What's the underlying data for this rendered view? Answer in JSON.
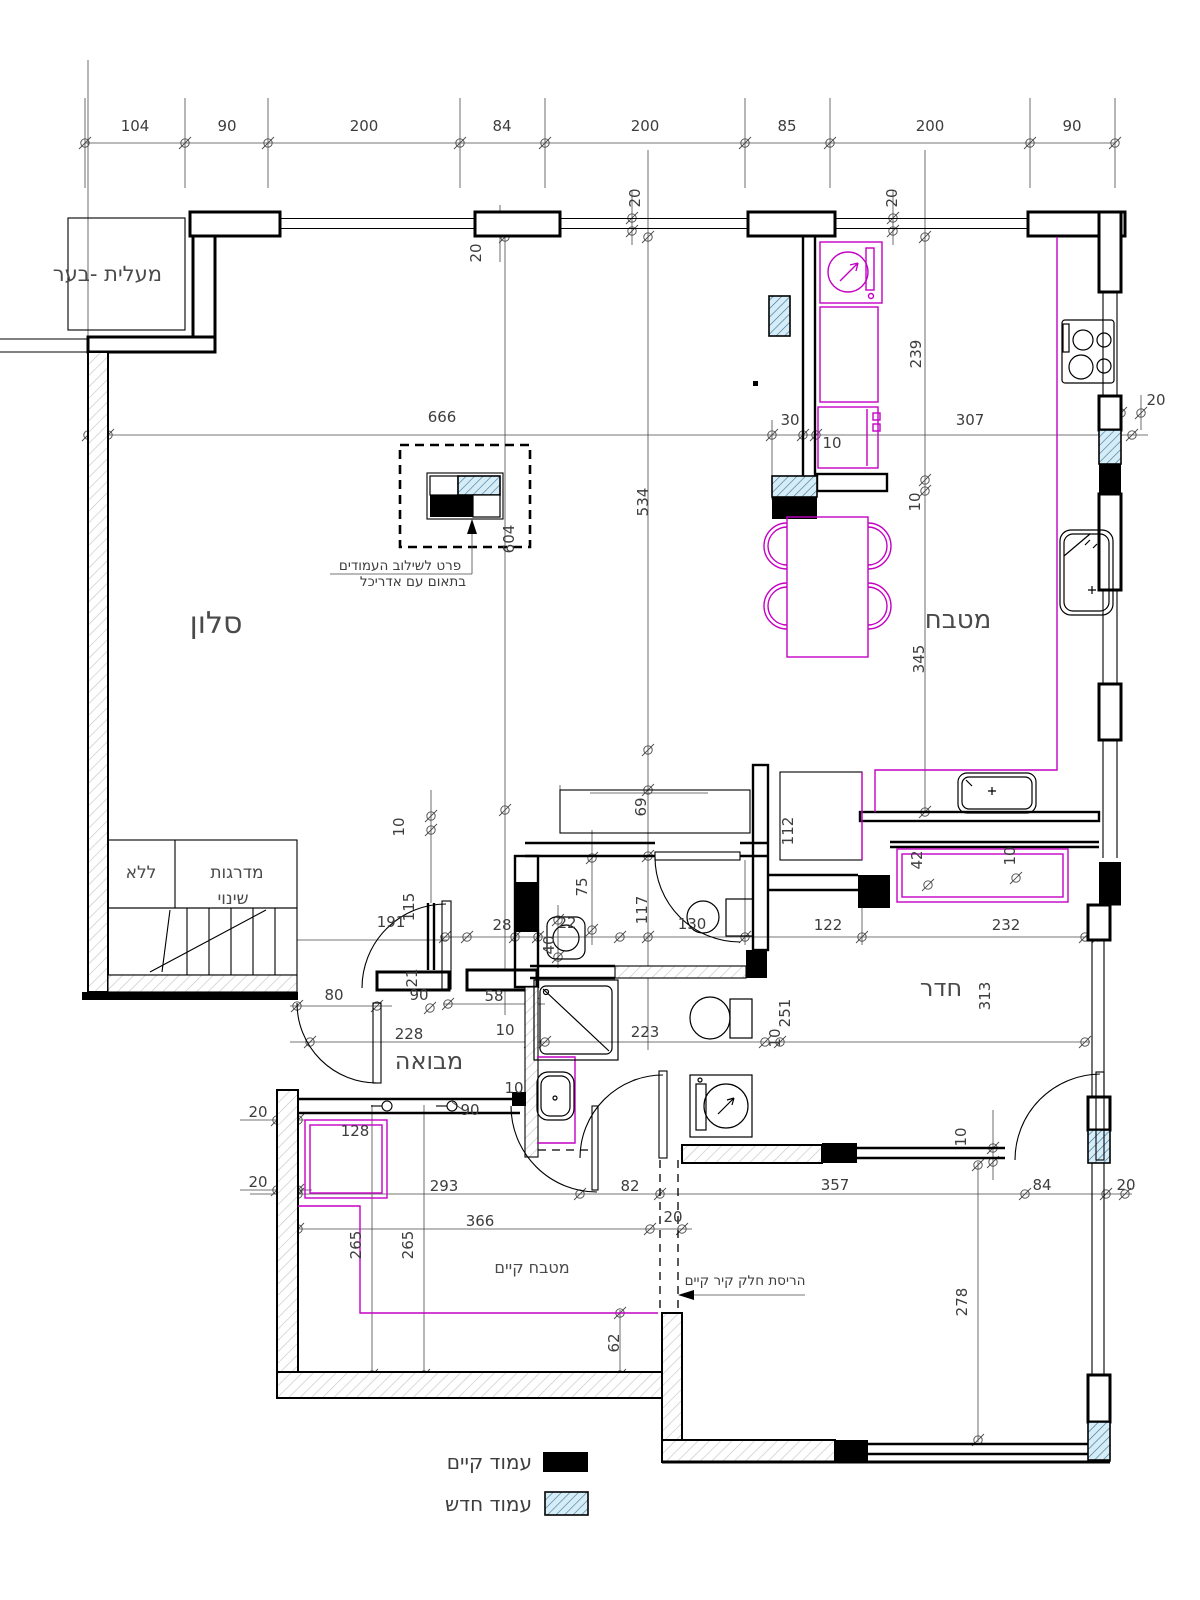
{
  "drawing": {
    "kind": "architectural-floor-plan",
    "language": "hebrew"
  },
  "colors": {
    "walls": "#000000",
    "furniture_accent": "#C400C4",
    "new_column_fill": "#D6EDF8",
    "new_column_hatch": "#35708F",
    "wall_hatch": "#C6C6C6",
    "text": "#3D3D3D"
  },
  "legend": {
    "existing": "עמוד קיים",
    "new": "עמוד חדש"
  },
  "notes": {
    "detail_line1": "פרט לשילוב העמודים",
    "detail_line2": "בתאום עם אדריכל",
    "demolition": "הריסת חלק קיר קיים"
  },
  "room_labels": [
    {
      "t": "סלון",
      "x": 216,
      "y": 633,
      "s": 30
    },
    {
      "t": "מטבח",
      "x": 958,
      "y": 628,
      "s": 26
    },
    {
      "t": "חדר",
      "x": 941,
      "y": 996,
      "s": 24
    },
    {
      "t": "מבואה",
      "x": 429,
      "y": 1069,
      "s": 24
    },
    {
      "t": "מטבח קיים",
      "x": 532,
      "y": 1273,
      "s": 16
    },
    {
      "t": "מעלית -בער",
      "x": 162,
      "y": 281,
      "s": 21,
      "a": "end"
    },
    {
      "t": "מדרגות",
      "x": 237,
      "y": 878,
      "s": 17
    },
    {
      "t": "ללא",
      "x": 141,
      "y": 878,
      "s": 17
    },
    {
      "t": "שינוי",
      "x": 233,
      "y": 904,
      "s": 17
    }
  ],
  "dim_labels": [
    {
      "v": 104,
      "x": 135,
      "y": 131
    },
    {
      "v": 90,
      "x": 227,
      "y": 131
    },
    {
      "v": 200,
      "x": 364,
      "y": 131
    },
    {
      "v": 84,
      "x": 502,
      "y": 131
    },
    {
      "v": 200,
      "x": 645,
      "y": 131
    },
    {
      "v": 85,
      "x": 787,
      "y": 131
    },
    {
      "v": 200,
      "x": 930,
      "y": 131
    },
    {
      "v": 90,
      "x": 1072,
      "y": 131
    },
    {
      "v": 20,
      "x": 481,
      "y": 253,
      "r": 1
    },
    {
      "v": 20,
      "x": 640,
      "y": 198,
      "r": 1
    },
    {
      "v": 20,
      "x": 897,
      "y": 198,
      "r": 1
    },
    {
      "v": 20,
      "x": 1156,
      "y": 405
    },
    {
      "v": 666,
      "x": 442,
      "y": 422
    },
    {
      "v": 30,
      "x": 790,
      "y": 425
    },
    {
      "v": 10,
      "x": 832,
      "y": 448
    },
    {
      "v": 307,
      "x": 970,
      "y": 425
    },
    {
      "v": 239,
      "x": 921,
      "y": 354,
      "r": 1
    },
    {
      "v": 10,
      "x": 920,
      "y": 502,
      "r": 1
    },
    {
      "v": 345,
      "x": 924,
      "y": 659,
      "r": 1
    },
    {
      "v": 604,
      "x": 514,
      "y": 539,
      "r": 1
    },
    {
      "v": 534,
      "x": 648,
      "y": 502,
      "r": 1
    },
    {
      "v": 69,
      "x": 646,
      "y": 807,
      "r": 1
    },
    {
      "v": 112,
      "x": 793,
      "y": 831,
      "r": 1
    },
    {
      "v": 42,
      "x": 922,
      "y": 860,
      "r": 1
    },
    {
      "v": 10,
      "x": 1015,
      "y": 856,
      "r": 1
    },
    {
      "v": 75,
      "x": 587,
      "y": 887,
      "r": 1
    },
    {
      "v": 117,
      "x": 647,
      "y": 910,
      "r": 1
    },
    {
      "v": 130,
      "x": 692,
      "y": 929
    },
    {
      "v": 122,
      "x": 828,
      "y": 930
    },
    {
      "v": 232,
      "x": 1006,
      "y": 930
    },
    {
      "v": 28,
      "x": 502,
      "y": 930
    },
    {
      "v": 22,
      "x": 567,
      "y": 928
    },
    {
      "v": 40,
      "x": 554,
      "y": 945,
      "r": 1
    },
    {
      "v": 191,
      "x": 391,
      "y": 927
    },
    {
      "v": 115,
      "x": 414,
      "y": 907,
      "r": 1
    },
    {
      "v": 21,
      "x": 417,
      "y": 978,
      "r": 1
    },
    {
      "v": 90,
      "x": 419,
      "y": 1000
    },
    {
      "v": 58,
      "x": 494,
      "y": 1001
    },
    {
      "v": 80,
      "x": 334,
      "y": 1000
    },
    {
      "v": 10,
      "x": 404,
      "y": 827,
      "r": 1
    },
    {
      "v": 313,
      "x": 990,
      "y": 996,
      "r": 1
    },
    {
      "v": 251,
      "x": 790,
      "y": 1013,
      "r": 1
    },
    {
      "v": 10,
      "x": 780,
      "y": 1038,
      "r": 1
    },
    {
      "v": 223,
      "x": 645,
      "y": 1037
    },
    {
      "v": 10,
      "x": 505,
      "y": 1035
    },
    {
      "v": 228,
      "x": 409,
      "y": 1039
    },
    {
      "v": 90,
      "x": 470,
      "y": 1115
    },
    {
      "v": 10,
      "x": 514,
      "y": 1093
    },
    {
      "v": 20,
      "x": 258,
      "y": 1117
    },
    {
      "v": 20,
      "x": 258,
      "y": 1187
    },
    {
      "v": 128,
      "x": 355,
      "y": 1136
    },
    {
      "v": 293,
      "x": 444,
      "y": 1191
    },
    {
      "v": 82,
      "x": 630,
      "y": 1191
    },
    {
      "v": 357,
      "x": 835,
      "y": 1190
    },
    {
      "v": 84,
      "x": 1042,
      "y": 1190
    },
    {
      "v": 20,
      "x": 1126,
      "y": 1190
    },
    {
      "v": 366,
      "x": 480,
      "y": 1226
    },
    {
      "v": 20,
      "x": 673,
      "y": 1222
    },
    {
      "v": 265,
      "x": 361,
      "y": 1245,
      "r": 1
    },
    {
      "v": 265,
      "x": 413,
      "y": 1245,
      "r": 1
    },
    {
      "v": 62,
      "x": 619,
      "y": 1343,
      "r": 1
    },
    {
      "v": 278,
      "x": 967,
      "y": 1302,
      "r": 1
    },
    {
      "v": 10,
      "x": 966,
      "y": 1137,
      "r": 1
    }
  ]
}
